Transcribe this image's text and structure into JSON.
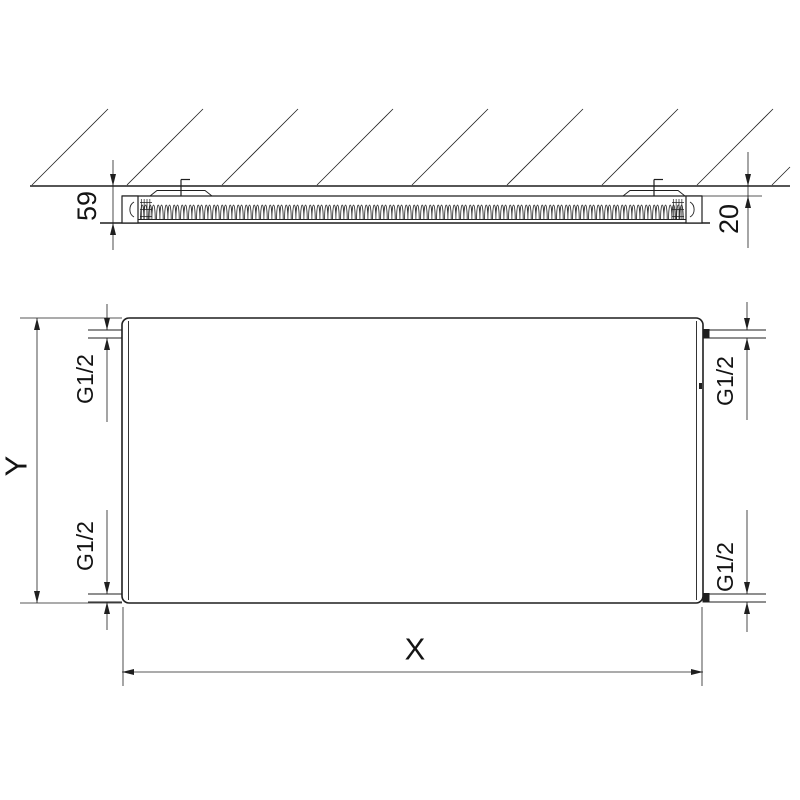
{
  "colors": {
    "background": "#ffffff",
    "line": "#1f1f1f",
    "text": "#141414"
  },
  "top_view": {
    "depth_label": "59",
    "wall_gap_label": "20"
  },
  "front_view": {
    "height_label": "Y",
    "width_label": "X",
    "conn_top_left": "G1/2",
    "conn_top_right": "G1/2",
    "conn_bottom_left": "G1/2",
    "conn_bottom_right": "G1/2"
  }
}
